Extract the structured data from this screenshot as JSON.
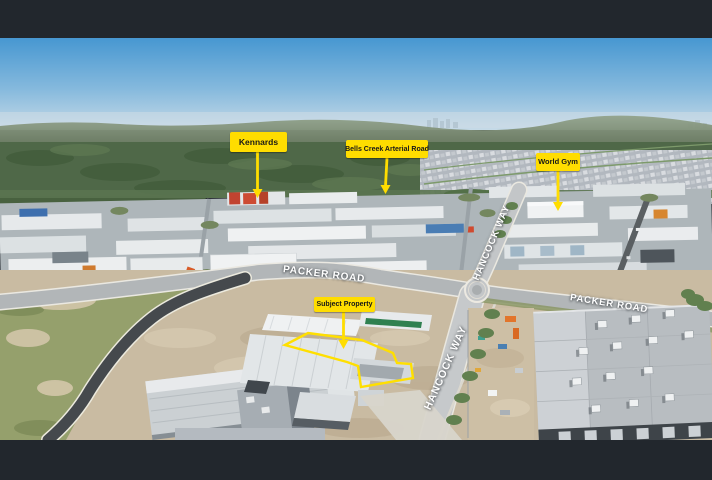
{
  "annotations": {
    "kennards": {
      "label": "Kennards"
    },
    "bells_creek_arterial_road": {
      "label": "Bells Creek Arterial Road"
    },
    "world_gym": {
      "label": "World Gym"
    },
    "subject_property": {
      "label": "Subject Property"
    }
  },
  "road_labels": {
    "packer_road_left": "PACKER ROAD",
    "packer_road_right": "PACKER ROAD",
    "hancock_way_upper": "HANCOCK WAY",
    "hancock_way_lower": "HANCOCK WAY"
  },
  "colors": {
    "annotation_yellow": "#FFDD00",
    "annotation_text": "#181818",
    "road_label_text": "#FFFFFF",
    "letterbox_bar": "#22272D",
    "boundary_outline": "#FFDF00"
  }
}
